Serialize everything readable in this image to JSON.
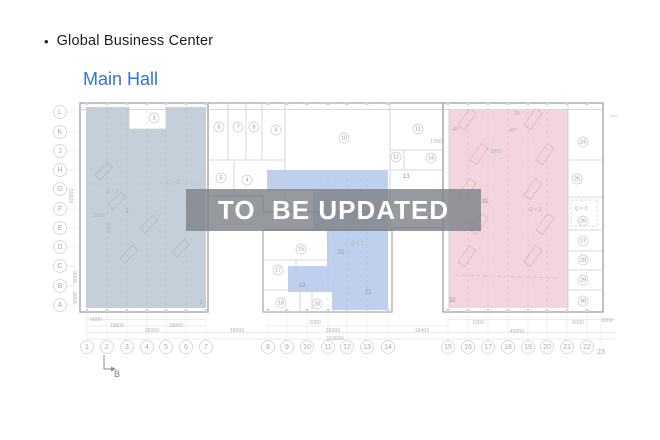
{
  "header": {
    "bullet": "•",
    "title": "Global Business Center",
    "subtitle": "Main Hall"
  },
  "watermark": {
    "text": "TO  BE UPDATED"
  },
  "colors": {
    "title_text": "#1c1c1e",
    "subtitle_blue": "#3173dd",
    "overlay_left": "rgba(150,168,188,0.55)",
    "overlay_middle": "rgba(125,162,220,0.50)",
    "overlay_right": "rgba(225,155,175,0.42)",
    "watermark_bg": "rgba(127,131,137,0.82)",
    "watermark_text": "#ffffff",
    "wall_outer": "#a3a7ad",
    "wall_inner": "#c9ccd1",
    "label_gray": "#95989d"
  },
  "plan": {
    "grid_rows": [
      {
        "label": "L",
        "x": 60,
        "y": 112
      },
      {
        "label": "K",
        "x": 60,
        "y": 132
      },
      {
        "label": "J",
        "x": 60,
        "y": 151
      },
      {
        "label": "H",
        "x": 60,
        "y": 170
      },
      {
        "label": "G",
        "x": 60,
        "y": 189
      },
      {
        "label": "F",
        "x": 60,
        "y": 209
      },
      {
        "label": "E",
        "x": 60,
        "y": 228
      },
      {
        "label": "D",
        "x": 60,
        "y": 247
      },
      {
        "label": "C",
        "x": 60,
        "y": 266
      },
      {
        "label": "B",
        "x": 60,
        "y": 286
      },
      {
        "label": "A",
        "x": 60,
        "y": 305
      }
    ],
    "grid_cols": [
      {
        "label": "1",
        "x": 87,
        "y": 347,
        "c": 1
      },
      {
        "label": "2",
        "x": 107,
        "y": 347,
        "c": 1
      },
      {
        "label": "3",
        "x": 127,
        "y": 347,
        "c": 1
      },
      {
        "label": "4",
        "x": 147,
        "y": 347,
        "c": 1
      },
      {
        "label": "5",
        "x": 166,
        "y": 347,
        "c": 1
      },
      {
        "label": "6",
        "x": 186,
        "y": 347,
        "c": 1
      },
      {
        "label": "7",
        "x": 206,
        "y": 347,
        "c": 1
      },
      {
        "label": "8",
        "x": 268,
        "y": 347,
        "c": 1
      },
      {
        "label": "9",
        "x": 287,
        "y": 347,
        "c": 1
      },
      {
        "label": "10",
        "x": 307,
        "y": 347,
        "c": 1
      },
      {
        "label": "11",
        "x": 328,
        "y": 347,
        "c": 1
      },
      {
        "label": "12",
        "x": 347,
        "y": 347,
        "c": 1
      },
      {
        "label": "13",
        "x": 367,
        "y": 347,
        "c": 1
      },
      {
        "label": "14",
        "x": 388,
        "y": 347,
        "c": 1
      },
      {
        "label": "15",
        "x": 448,
        "y": 347,
        "c": 1
      },
      {
        "label": "16",
        "x": 468,
        "y": 347,
        "c": 1
      },
      {
        "label": "17",
        "x": 488,
        "y": 347,
        "c": 1
      },
      {
        "label": "18",
        "x": 508,
        "y": 347,
        "c": 1
      },
      {
        "label": "19",
        "x": 528,
        "y": 347,
        "c": 1
      },
      {
        "label": "20",
        "x": 547,
        "y": 347,
        "c": 1
      },
      {
        "label": "21",
        "x": 567,
        "y": 347,
        "c": 1
      },
      {
        "label": "22",
        "x": 587,
        "y": 347,
        "c": 1
      },
      {
        "label": "23",
        "x": 601,
        "y": 352,
        "c": 0
      }
    ],
    "rooms": [
      {
        "n": "1",
        "x": 201,
        "y": 302,
        "c": 1
      },
      {
        "n": "2",
        "x": 127,
        "y": 211,
        "c": 1
      },
      {
        "n": "3",
        "x": 154,
        "y": 118,
        "c": 1
      },
      {
        "n": "4",
        "x": 247,
        "y": 180,
        "c": 1
      },
      {
        "n": "5",
        "x": 221,
        "y": 178,
        "c": 1
      },
      {
        "n": "6",
        "x": 219,
        "y": 127,
        "c": 1
      },
      {
        "n": "7",
        "x": 238,
        "y": 127,
        "c": 1
      },
      {
        "n": "8",
        "x": 254,
        "y": 127,
        "c": 1
      },
      {
        "n": "9",
        "x": 276,
        "y": 130,
        "c": 1
      },
      {
        "n": "10",
        "x": 344,
        "y": 138,
        "c": 1
      },
      {
        "n": "11",
        "x": 418,
        "y": 129,
        "c": 1
      },
      {
        "n": "12",
        "x": 396,
        "y": 157,
        "c": 1
      },
      {
        "n": "13",
        "x": 406,
        "y": 176,
        "c": 0
      },
      {
        "n": "14",
        "x": 431,
        "y": 158,
        "c": 1
      },
      {
        "n": "15",
        "x": 301,
        "y": 249,
        "c": 1
      },
      {
        "n": "17",
        "x": 278,
        "y": 270,
        "c": 1
      },
      {
        "n": "18",
        "x": 281,
        "y": 303,
        "c": 1
      },
      {
        "n": "19",
        "x": 302,
        "y": 285,
        "c": 0
      },
      {
        "n": "20",
        "x": 317,
        "y": 304,
        "c": 1
      },
      {
        "n": "21",
        "x": 341,
        "y": 252,
        "c": 0
      },
      {
        "n": "22",
        "x": 368,
        "y": 292,
        "c": 0
      },
      {
        "n": "24",
        "x": 583,
        "y": 142,
        "c": 1
      },
      {
        "n": "25",
        "x": 577,
        "y": 179,
        "c": 1
      },
      {
        "n": "26",
        "x": 583,
        "y": 221,
        "c": 1
      },
      {
        "n": "27",
        "x": 583,
        "y": 241,
        "c": 1
      },
      {
        "n": "28",
        "x": 583,
        "y": 260,
        "c": 1
      },
      {
        "n": "29",
        "x": 583,
        "y": 280,
        "c": 1
      },
      {
        "n": "30",
        "x": 583,
        "y": 301,
        "c": 1
      },
      {
        "n": "31",
        "x": 485,
        "y": 201,
        "c": 0
      },
      {
        "n": "32",
        "x": 452,
        "y": 300,
        "c": 0
      }
    ],
    "annotations": [
      {
        "t": "Q + 3",
        "x": 112,
        "y": 192
      },
      {
        "t": "Q + 3",
        "x": 173,
        "y": 183
      },
      {
        "t": "2000",
        "x": 99,
        "y": 216
      },
      {
        "t": "2000",
        "x": 110,
        "y": 228,
        "rot": -90
      },
      {
        "t": "Q = 3",
        "x": 357,
        "y": 244
      },
      {
        "t": "Q = 3",
        "x": 475,
        "y": 224
      },
      {
        "t": "Q = 3",
        "x": 535,
        "y": 210
      },
      {
        "t": "Q = 3",
        "x": 581,
        "y": 209
      },
      {
        "t": "1000",
        "x": 436,
        "y": 142
      },
      {
        "t": "1800",
        "x": 496,
        "y": 152
      },
      {
        "t": "23",
        "x": 517,
        "y": 114
      },
      {
        "t": "45°",
        "x": 456,
        "y": 130
      },
      {
        "t": "45°",
        "x": 513,
        "y": 131
      }
    ],
    "dims_bottom": [
      {
        "t": "6000",
        "x": 96,
        "y": 320
      },
      {
        "t": "18000",
        "x": 117,
        "y": 326
      },
      {
        "t": "36000",
        "x": 152,
        "y": 331
      },
      {
        "t": "18000",
        "x": 176,
        "y": 326
      },
      {
        "t": "18000",
        "x": 237,
        "y": 331
      },
      {
        "t": "2000",
        "x": 315,
        "y": 323
      },
      {
        "t": "36000",
        "x": 333,
        "y": 331
      },
      {
        "t": "153600",
        "x": 335,
        "y": 339
      },
      {
        "t": "18400",
        "x": 422,
        "y": 331
      },
      {
        "t": "1000",
        "x": 478,
        "y": 323
      },
      {
        "t": "45000",
        "x": 517,
        "y": 332
      },
      {
        "t": "6000",
        "x": 578,
        "y": 323
      },
      {
        "t": "3000",
        "x": 607,
        "y": 321
      }
    ],
    "dims_left": [
      {
        "t": "60000",
        "x": 72,
        "y": 196,
        "rot": -90
      },
      {
        "t": "6000",
        "x": 76,
        "y": 277,
        "rot": -90
      },
      {
        "t": "6000",
        "x": 76,
        "y": 298,
        "rot": -90
      }
    ],
    "section_marker": {
      "label": "B",
      "x": 117,
      "y": 374
    }
  }
}
